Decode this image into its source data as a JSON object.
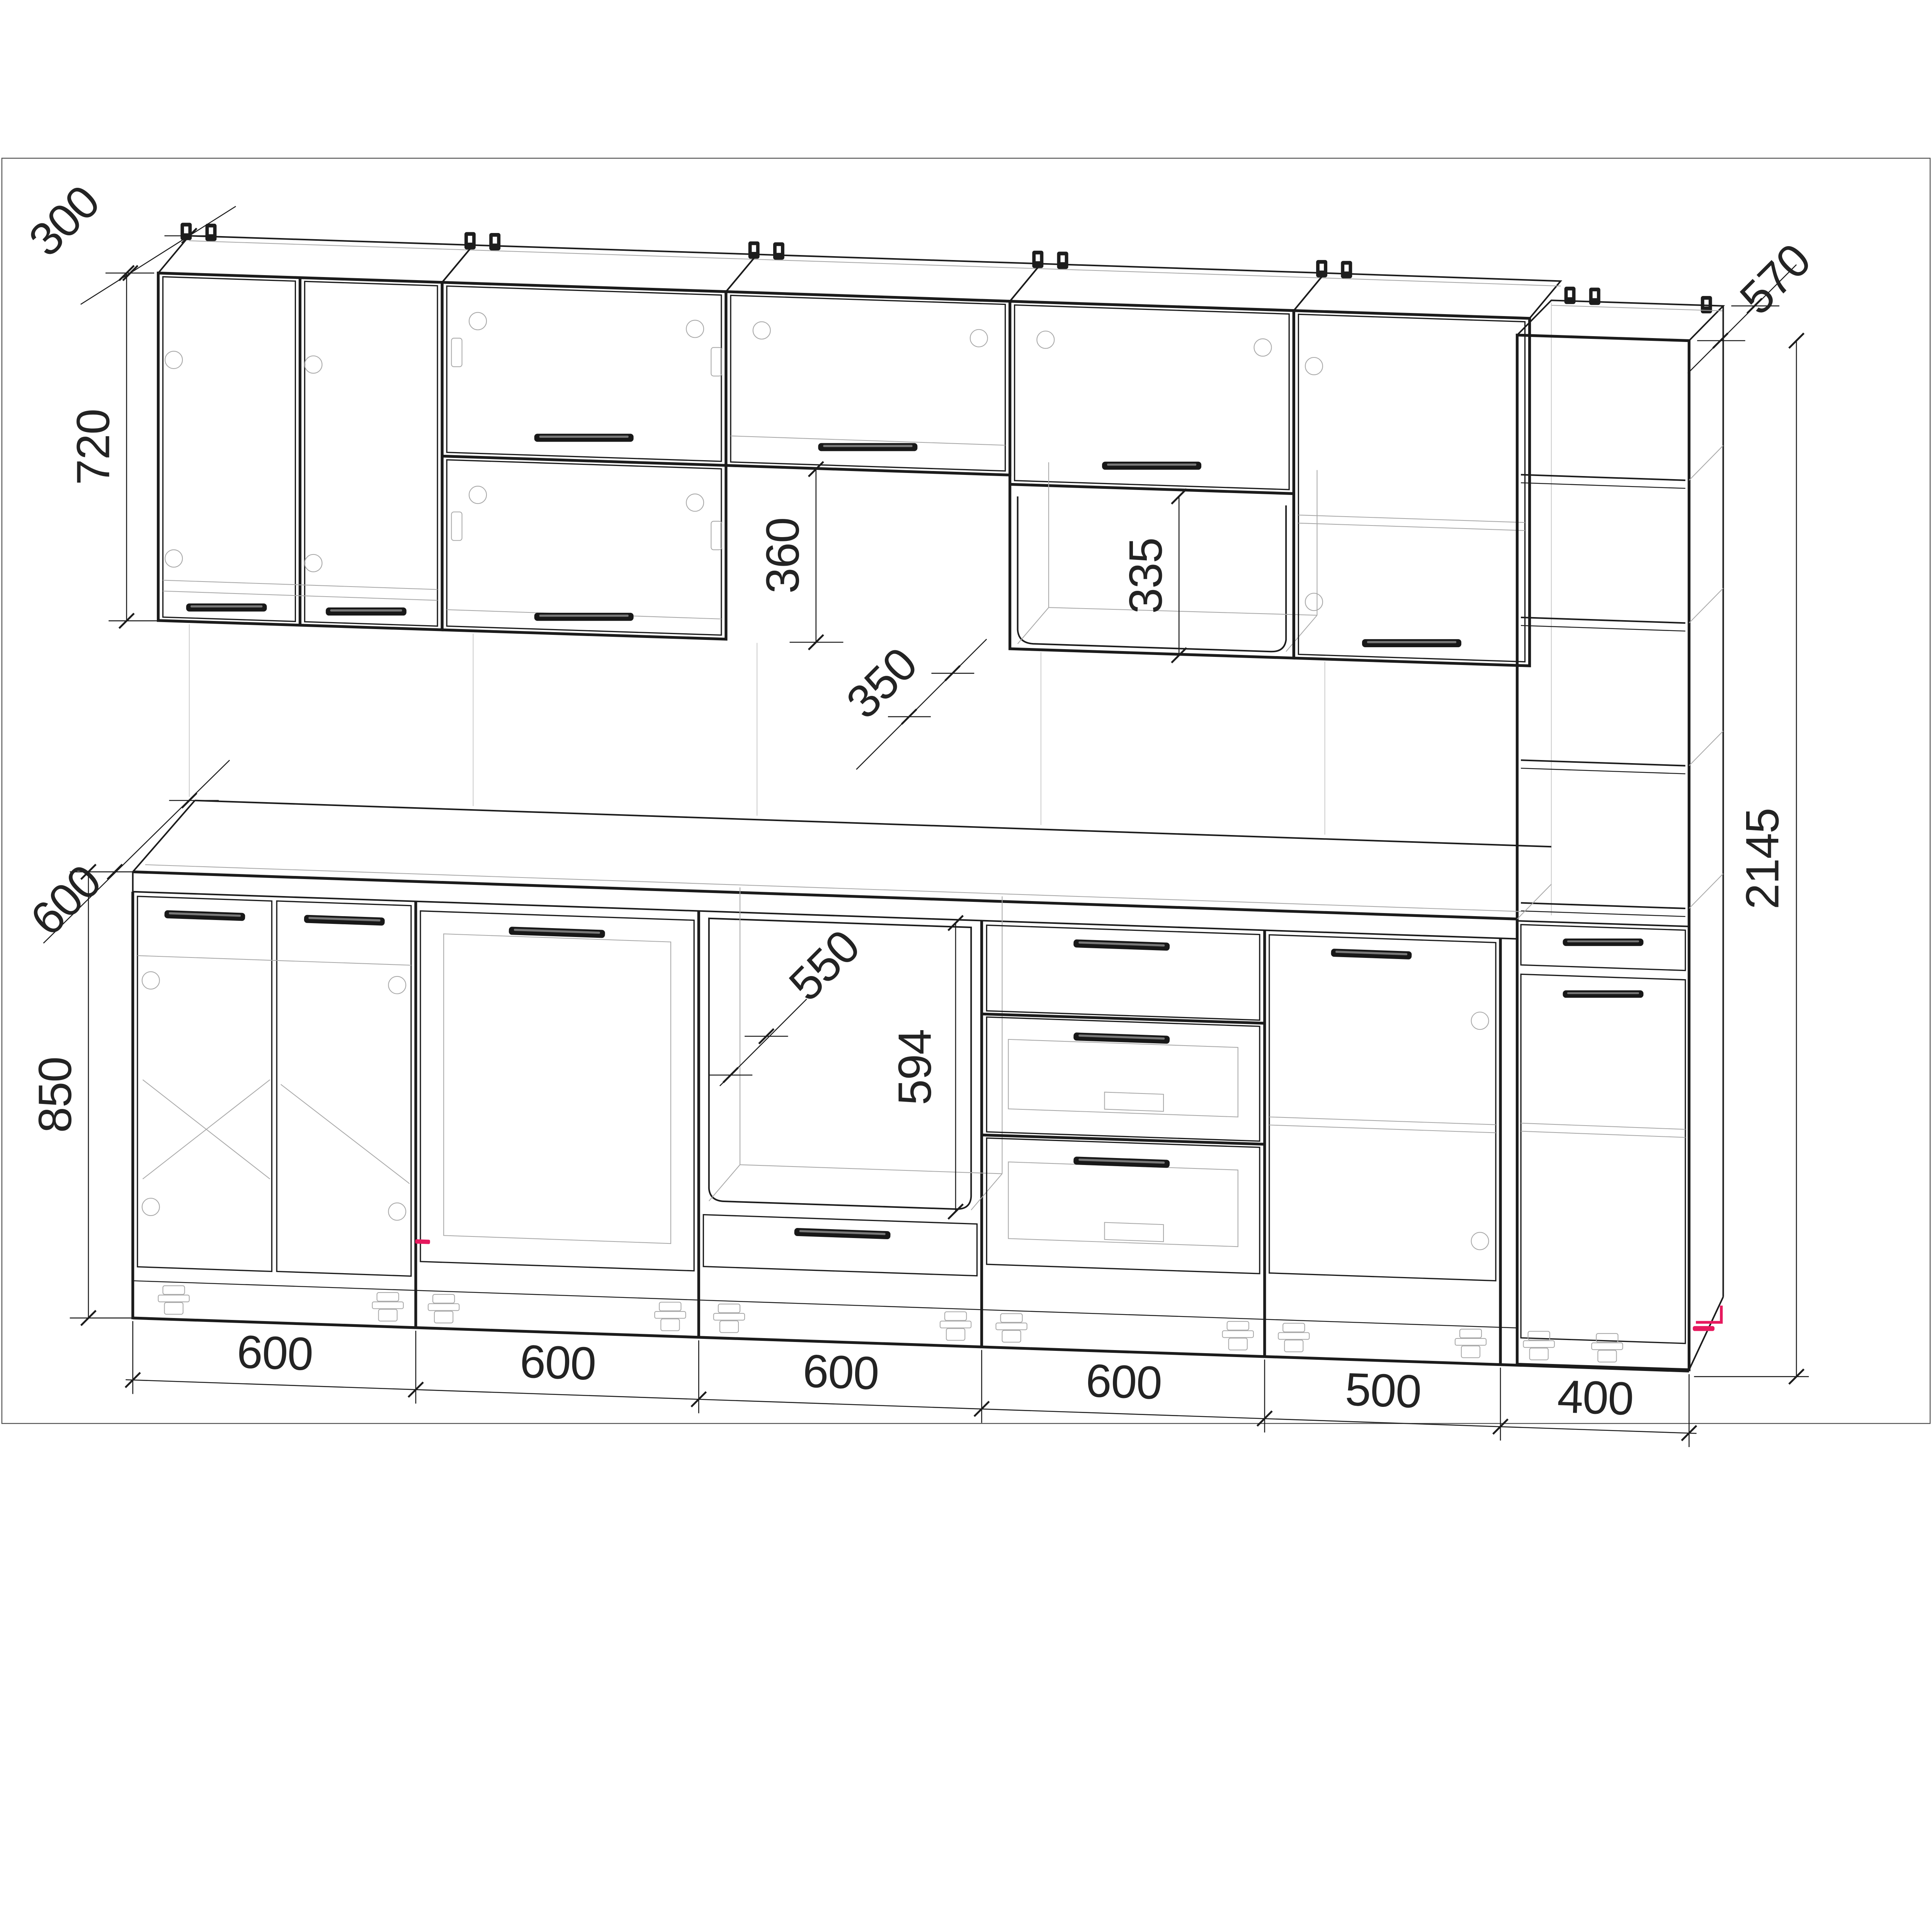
{
  "drawing": {
    "type": "kitchen-cabinet-assembly-technical-drawing",
    "style": "wireframe CAD perspective",
    "background": "#ffffff",
    "line_color": "#1b1b1b",
    "light_line_color": "#a8a8a8",
    "accent_color": "#e6195e",
    "border_color": "#4f4f4f"
  },
  "dims": {
    "wall_depth": "300",
    "wall_height": "720",
    "hood_gap_height": "360",
    "hood_gap_depth": "350",
    "wall_niche_height": "335",
    "tall_depth": "570",
    "tall_height": "2145",
    "base_depth": "600",
    "base_height": "850",
    "oven_niche_depth": "550",
    "oven_niche_height": "594",
    "widths": [
      "600",
      "600",
      "600",
      "600",
      "500",
      "400"
    ]
  },
  "components": {
    "wall_cabinets": [
      "double-door 600",
      "double flip-up 600",
      "short flip-up 600",
      "flip-up with open niche 600",
      "single-door 500"
    ],
    "tall_cabinet": "open shelving column with drawer and door 400",
    "base_cabinets": [
      "sink double-door 600",
      "appliance door 600",
      "oven niche with drawer 600",
      "three-drawer 600",
      "single-door 500",
      "tall column base 400"
    ]
  }
}
